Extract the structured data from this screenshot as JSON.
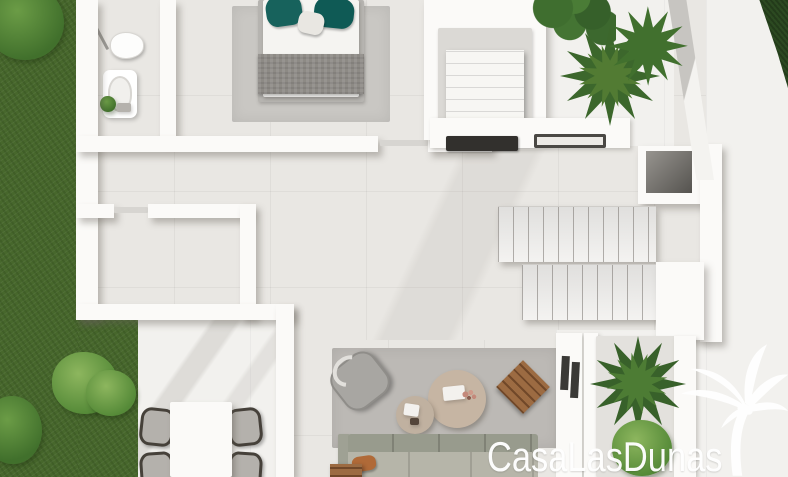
{
  "watermark": {
    "text": "CasaLasDunas",
    "color": "#ffffff",
    "icon": "palm-tree-icon"
  },
  "palette": {
    "grass": "#47672c",
    "bush_light": "#6da04a",
    "hedge": "#2c4a21",
    "floor_interior": "#e9e7e3",
    "floor_terrace": "#f2f1ee",
    "wall": "#fbfaf8",
    "rug_bedroom": "#c9c7c3",
    "rug_living": "#bcb9b5",
    "bed_blanket": "#8d8a85",
    "pillow_teal": "#14605a",
    "sofa": "#b5b4a8",
    "pillow_orange": "#b06a38",
    "wood": "#9c6b42",
    "coffee_table": "#c6b5a3",
    "plant_dark": "#38612a",
    "cooktop": "#32302d"
  },
  "scene": [
    {
      "n": "interior-floor",
      "t": "floor-in",
      "x": 78,
      "y": 0,
      "w": 644,
      "h": 346
    },
    {
      "n": "living-floor",
      "t": "floor-in",
      "x": 292,
      "y": 340,
      "w": 266,
      "h": 137
    },
    {
      "n": "terrace-bottom-left-floor",
      "t": "floor-out",
      "x": 130,
      "y": 316,
      "w": 164,
      "h": 161
    },
    {
      "n": "terrace-right-floor",
      "t": "floor-out",
      "x": 706,
      "y": 0,
      "w": 82,
      "h": 477
    },
    {
      "n": "terrace-top-floor",
      "t": "floor-out",
      "x": 544,
      "y": 0,
      "w": 130,
      "h": 146
    },
    {
      "n": "planter-area-floor",
      "t": "floor-out",
      "x": 556,
      "y": 330,
      "w": 150,
      "h": 147
    },
    {
      "n": "terrace-shade",
      "t": "shade shade-a",
      "x": 130,
      "y": 316,
      "w": 164,
      "h": 161
    },
    {
      "n": "floor-shade",
      "t": "shade shade-b",
      "x": 180,
      "y": 150,
      "w": 420,
      "h": 190
    },
    {
      "n": "grass-left-strip",
      "t": "grass",
      "x": 0,
      "y": 0,
      "w": 80,
      "h": 477
    },
    {
      "n": "grass-bottom-left",
      "t": "grass",
      "x": 78,
      "y": 316,
      "w": 60,
      "h": 161
    },
    {
      "n": "bush-top-left",
      "t": "bush",
      "x": -14,
      "y": -16,
      "w": 78,
      "h": 76
    },
    {
      "n": "bush-garden-1",
      "t": "bush light",
      "x": 52,
      "y": 352,
      "w": 66,
      "h": 62
    },
    {
      "n": "bush-garden-2",
      "t": "bush",
      "x": -16,
      "y": 396,
      "w": 58,
      "h": 68
    },
    {
      "n": "bush-garden-3",
      "t": "bush light",
      "x": 86,
      "y": 370,
      "w": 50,
      "h": 46
    },
    {
      "n": "hedge-top-right",
      "t": "hedge",
      "x": 744,
      "y": 0,
      "w": 44,
      "h": 88
    },
    {
      "n": "bedroom-rug",
      "t": "rug",
      "x": 232,
      "y": 6,
      "w": 158,
      "h": 116,
      "c": "#c9c7c3"
    },
    {
      "n": "bed-frame",
      "t": "panel",
      "x": 258,
      "y": 0,
      "w": 106,
      "h": 102,
      "c": "#b6b4b0"
    },
    {
      "n": "bed-sheet",
      "t": "panel",
      "x": 263,
      "y": 0,
      "w": 96,
      "h": 97,
      "c": "#f5f4f1"
    },
    {
      "n": "bed-blanket",
      "t": "blanket",
      "x": 258,
      "y": 54,
      "w": 106,
      "h": 40
    },
    {
      "n": "bed-pillow-teal-left",
      "t": "pillow",
      "x": 266,
      "y": -4,
      "w": 36,
      "h": 30,
      "c": "#17625c",
      "r": -8
    },
    {
      "n": "bed-pillow-teal-right",
      "t": "pillow",
      "x": 314,
      "y": -2,
      "w": 40,
      "h": 30,
      "c": "#0f5a55",
      "r": 6
    },
    {
      "n": "bed-pillow-white",
      "t": "pillow",
      "x": 298,
      "y": 12,
      "w": 26,
      "h": 22,
      "c": "#e9e7e2",
      "r": 12
    },
    {
      "n": "shower-screen",
      "t": "line",
      "x": 96,
      "y": 8,
      "w": 3,
      "h": 44,
      "c": "#9a9894",
      "r": -28
    },
    {
      "n": "toilet",
      "t": "toilet",
      "x": 110,
      "y": 32,
      "w": 34,
      "h": 27
    },
    {
      "n": "bathtub",
      "t": "tub",
      "x": 103,
      "y": 70,
      "w": 34,
      "h": 48
    },
    {
      "n": "bathtub-basin",
      "t": "tub-in",
      "x": 108,
      "y": 76,
      "w": 24,
      "h": 36
    },
    {
      "n": "bathroom-plant",
      "t": "bush",
      "x": 100,
      "y": 96,
      "w": 16,
      "h": 16
    },
    {
      "n": "bathroom-tray",
      "t": "panel",
      "x": 117,
      "y": 103,
      "w": 14,
      "h": 9,
      "c": "#b5b2ad"
    },
    {
      "n": "wall-left-outer",
      "t": "wall",
      "x": 76,
      "y": 0,
      "w": 22,
      "h": 320
    },
    {
      "n": "wall-bathroom-right",
      "t": "wall",
      "x": 160,
      "y": 0,
      "w": 16,
      "h": 141
    },
    {
      "n": "wall-hallway-top",
      "t": "wall",
      "x": 76,
      "y": 136,
      "w": 302,
      "h": 16
    },
    {
      "n": "bedroom-door",
      "t": "line",
      "x": 380,
      "y": 140,
      "w": 48,
      "h": 6,
      "c": "#d7d5d1"
    },
    {
      "n": "wall-hallway-top-b",
      "t": "wall",
      "x": 428,
      "y": 136,
      "w": 64,
      "h": 16
    },
    {
      "n": "wall-room-top-a",
      "t": "wall",
      "x": 76,
      "y": 204,
      "w": 38,
      "h": 14
    },
    {
      "n": "room-door",
      "t": "line",
      "x": 114,
      "y": 207,
      "w": 34,
      "h": 6,
      "c": "#d7d5d1"
    },
    {
      "n": "wall-room-top-b",
      "t": "wall",
      "x": 148,
      "y": 204,
      "w": 102,
      "h": 14
    },
    {
      "n": "wall-room-right",
      "t": "wall",
      "x": 240,
      "y": 204,
      "w": 16,
      "h": 114
    },
    {
      "n": "wall-room-bottom",
      "t": "wall",
      "x": 76,
      "y": 304,
      "w": 218,
      "h": 16
    },
    {
      "n": "wall-terrace-divider",
      "t": "wall",
      "x": 276,
      "y": 304,
      "w": 18,
      "h": 173
    },
    {
      "n": "closet-walls",
      "t": "wall",
      "x": 424,
      "y": 0,
      "w": 122,
      "h": 140
    },
    {
      "n": "closet-interior",
      "t": "panel",
      "x": 438,
      "y": 28,
      "w": 94,
      "h": 102,
      "c": "#dbd9d5"
    },
    {
      "n": "closet-linens",
      "t": "stack",
      "x": 446,
      "y": 50,
      "w": 78,
      "h": 74
    },
    {
      "n": "kitchen-counter",
      "t": "wall-flat",
      "x": 430,
      "y": 118,
      "w": 200,
      "h": 30
    },
    {
      "n": "cooktop",
      "t": "hob",
      "x": 446,
      "y": 136,
      "w": 72,
      "h": 15
    },
    {
      "n": "kitchen-sink",
      "t": "sink",
      "x": 534,
      "y": 134,
      "w": 72,
      "h": 14
    },
    {
      "n": "stair-landing",
      "t": "wall",
      "x": 638,
      "y": 146,
      "w": 76,
      "h": 58
    },
    {
      "n": "stair-landing-void",
      "t": "recess",
      "x": 646,
      "y": 151,
      "w": 46,
      "h": 42
    },
    {
      "n": "stair-flight-upper",
      "t": "steps",
      "x": 498,
      "y": 206,
      "w": 158,
      "h": 56
    },
    {
      "n": "stair-flight-lower",
      "t": "steps",
      "x": 522,
      "y": 264,
      "w": 140,
      "h": 56
    },
    {
      "n": "stair-wall-right",
      "t": "wall",
      "x": 700,
      "y": 144,
      "w": 22,
      "h": 198
    },
    {
      "n": "stair-wall-inner",
      "t": "wall",
      "x": 656,
      "y": 262,
      "w": 48,
      "h": 78
    },
    {
      "n": "wall-diagonal",
      "t": "diag",
      "x": 668,
      "y": 0,
      "w": 46,
      "h": 180
    },
    {
      "n": "living-rug",
      "t": "rug",
      "x": 332,
      "y": 348,
      "w": 226,
      "h": 100,
      "c": "#bcb9b5"
    },
    {
      "n": "armchair",
      "t": "armchair",
      "x": 334,
      "y": 356,
      "w": 52,
      "h": 50,
      "r": -38
    },
    {
      "n": "armchair-handle",
      "t": "ring",
      "x": 332,
      "y": 356,
      "w": 34,
      "h": 30,
      "r": -38
    },
    {
      "n": "coffee-table-large",
      "t": "circle",
      "x": 428,
      "y": 370,
      "w": 58,
      "h": 58,
      "c": "#c6b5a3"
    },
    {
      "n": "coffee-table-small",
      "t": "circle",
      "x": 396,
      "y": 396,
      "w": 38,
      "h": 38,
      "c": "#c0b1a0"
    },
    {
      "n": "table-tray",
      "t": "panel",
      "x": 443,
      "y": 386,
      "w": 22,
      "h": 14,
      "c": "#f3f1ee",
      "r": -6
    },
    {
      "n": "table-dried-flowers",
      "t": "flowers",
      "x": 460,
      "y": 388,
      "w": 18,
      "h": 16
    },
    {
      "n": "table-napkin",
      "t": "panel",
      "x": 404,
      "y": 404,
      "w": 15,
      "h": 12,
      "c": "#f3f1ee",
      "r": 8
    },
    {
      "n": "table-dark-item",
      "t": "panel",
      "x": 410,
      "y": 418,
      "w": 9,
      "h": 7,
      "c": "#54453a"
    },
    {
      "n": "wooden-side-stool",
      "t": "wood slats",
      "x": 504,
      "y": 368,
      "w": 38,
      "h": 38,
      "r": 45
    },
    {
      "n": "sofa-armrest",
      "t": "panel",
      "x": 338,
      "y": 434,
      "w": 12,
      "h": 43,
      "c": "#9fa194"
    },
    {
      "n": "sofa-back-cushions",
      "t": "sofa-back",
      "x": 348,
      "y": 434,
      "w": 190,
      "h": 22
    },
    {
      "n": "sofa-seat-cushions",
      "t": "sofa-seat",
      "x": 348,
      "y": 452,
      "w": 190,
      "h": 25
    },
    {
      "n": "sofa-pillow-orange",
      "t": "pillow",
      "x": 352,
      "y": 456,
      "w": 24,
      "h": 15,
      "c": "#b06a38",
      "r": -8
    },
    {
      "n": "sofa-side-wood",
      "t": "wood slats",
      "x": 330,
      "y": 464,
      "w": 32,
      "h": 13
    },
    {
      "n": "wall-window-slits",
      "t": "wall-flat",
      "x": 556,
      "y": 333,
      "w": 26,
      "h": 144
    },
    {
      "n": "window-slit-1",
      "t": "dark",
      "x": 561,
      "y": 356,
      "w": 8,
      "h": 34,
      "r": 3
    },
    {
      "n": "window-slit-2",
      "t": "dark",
      "x": 571,
      "y": 362,
      "w": 8,
      "h": 36,
      "r": 3
    },
    {
      "n": "planter-wall-left",
      "t": "wall-flat",
      "x": 584,
      "y": 333,
      "w": 14,
      "h": 144
    },
    {
      "n": "planter-box",
      "t": "panel",
      "x": 596,
      "y": 336,
      "w": 80,
      "h": 141,
      "c": "#e3e1dd"
    },
    {
      "n": "planter-wall-right",
      "t": "wall-flat",
      "x": 674,
      "y": 336,
      "w": 22,
      "h": 141
    },
    {
      "n": "planter-fern",
      "t": "fern",
      "x": 590,
      "y": 336,
      "w": 96,
      "h": 96,
      "c": "#38612a"
    },
    {
      "n": "planter-fern-inner",
      "t": "fern",
      "x": 606,
      "y": 352,
      "w": 62,
      "h": 62,
      "c": "#4d7c34",
      "r": 20
    },
    {
      "n": "planter-bush",
      "t": "bush light",
      "x": 612,
      "y": 420,
      "w": 60,
      "h": 56
    },
    {
      "n": "dining-chair-1",
      "t": "chair",
      "x": 140,
      "y": 408,
      "w": 34,
      "h": 38,
      "r": 6
    },
    {
      "n": "dining-chair-2",
      "t": "chair",
      "x": 140,
      "y": 452,
      "w": 34,
      "h": 38,
      "r": -4
    },
    {
      "n": "dining-chair-3",
      "t": "chair",
      "x": 228,
      "y": 408,
      "w": 34,
      "h": 38,
      "r": -6
    },
    {
      "n": "dining-chair-4",
      "t": "chair",
      "x": 228,
      "y": 452,
      "w": 34,
      "h": 38,
      "r": 4
    },
    {
      "n": "dining-table",
      "t": "panel table",
      "x": 170,
      "y": 402,
      "w": 62,
      "h": 75,
      "c": "#fbfaf8"
    },
    {
      "n": "plant-roundleaf",
      "t": "leafy",
      "x": 532,
      "y": -20,
      "w": 84,
      "h": 70
    },
    {
      "n": "palm-plant-1",
      "t": "fern",
      "x": 560,
      "y": 26,
      "w": 100,
      "h": 100,
      "c": "#3c672c"
    },
    {
      "n": "palm-plant-1-inner",
      "t": "fern",
      "x": 578,
      "y": 44,
      "w": 64,
      "h": 64,
      "c": "#527b33",
      "r": 15
    },
    {
      "n": "palm-plant-2",
      "t": "fern",
      "x": 608,
      "y": 6,
      "w": 80,
      "h": 80,
      "c": "#41702e",
      "r": 30
    }
  ]
}
